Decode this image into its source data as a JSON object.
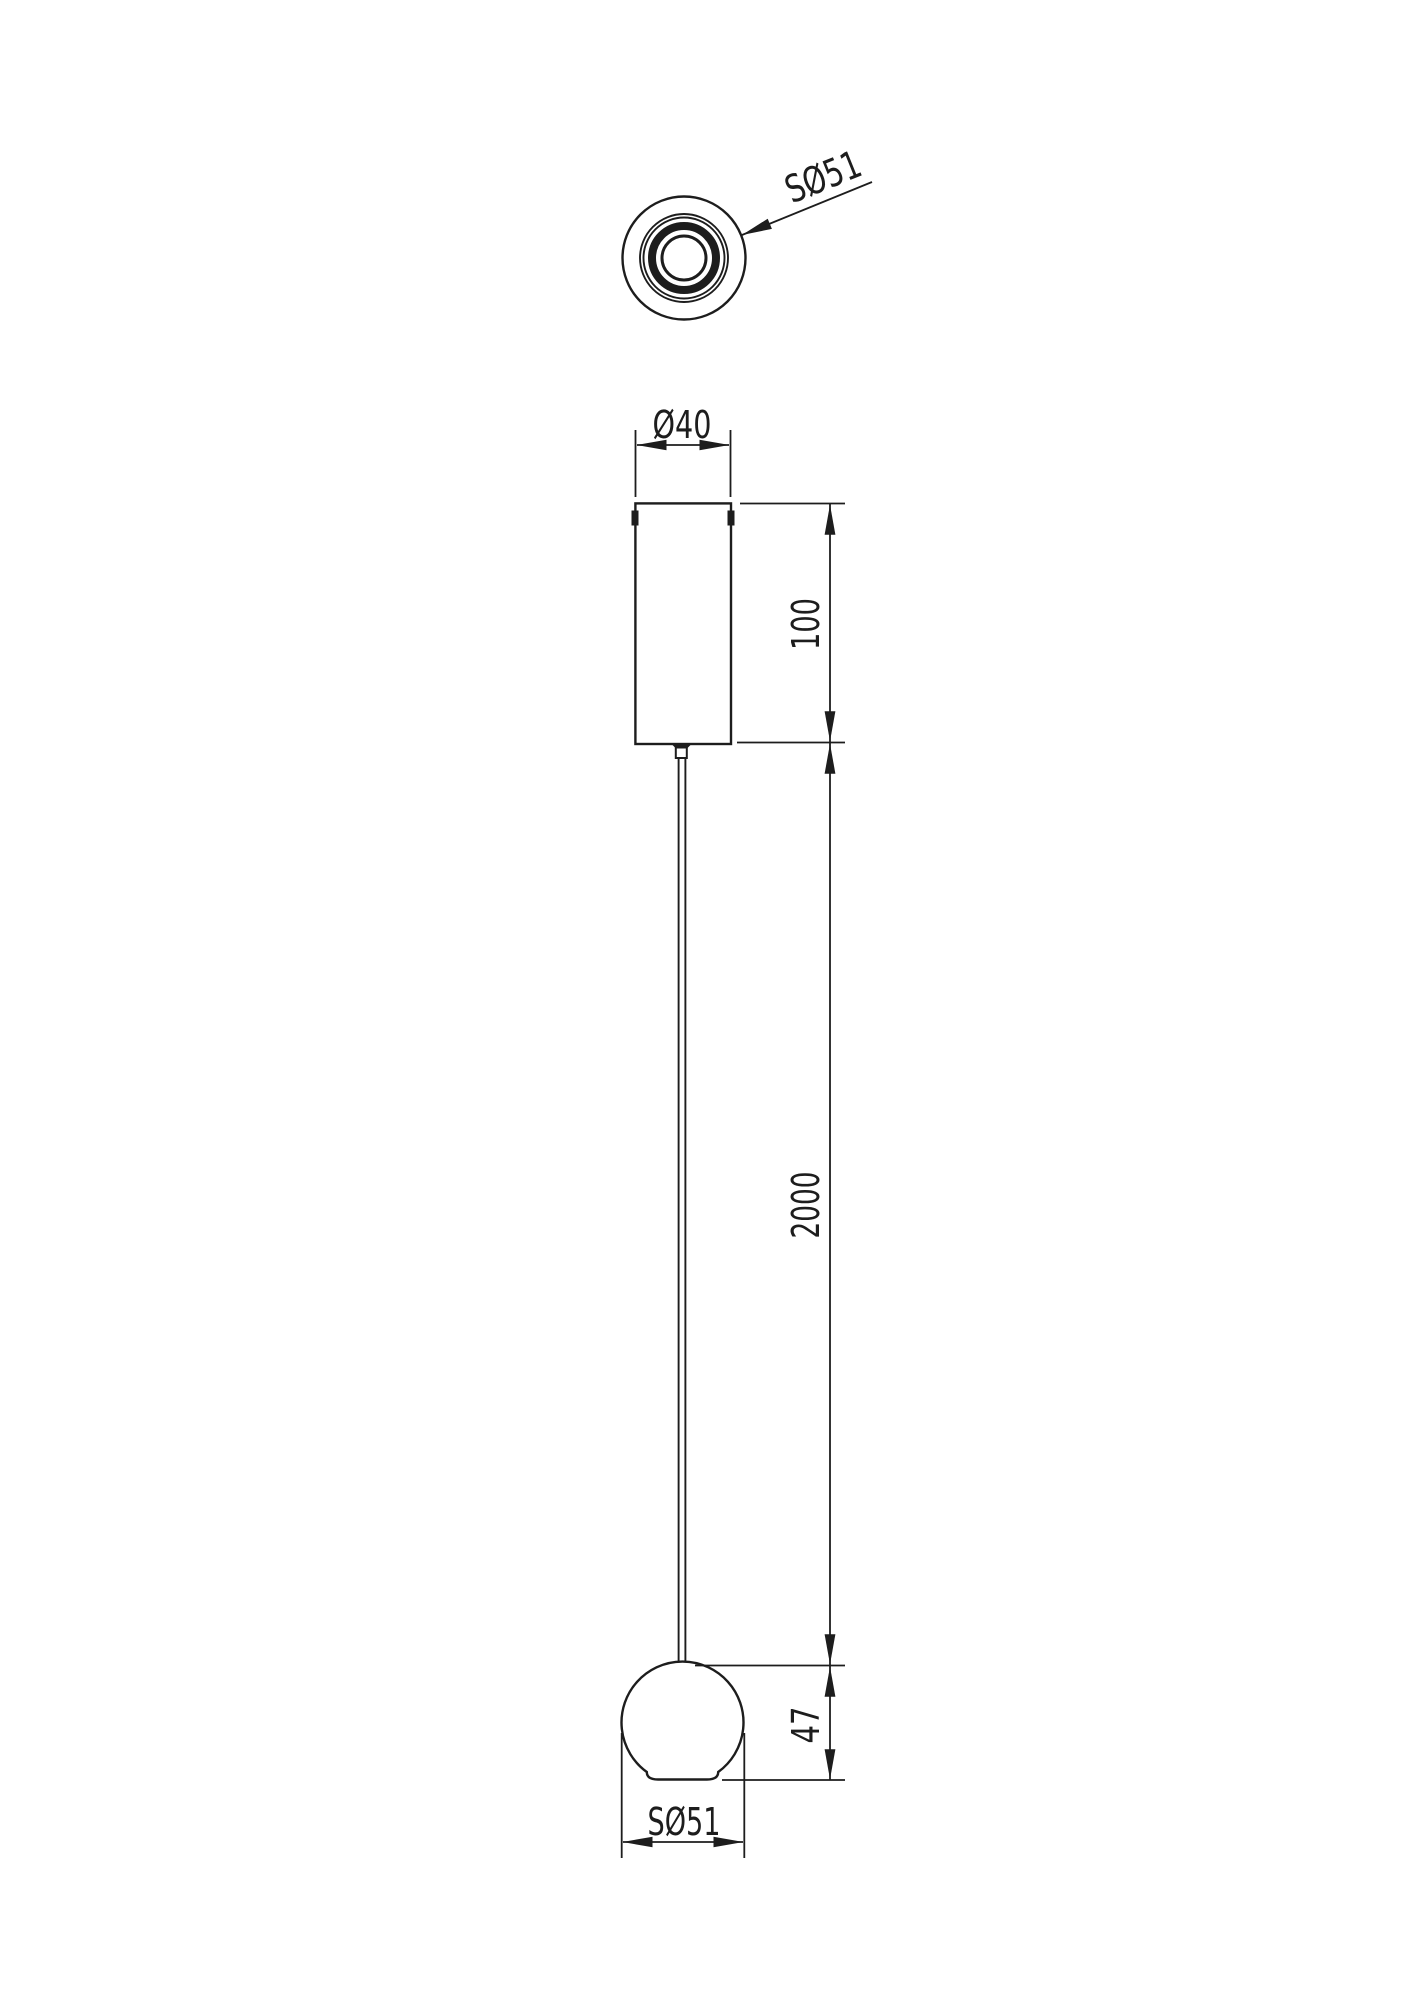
{
  "colors": {
    "background": "#ffffff",
    "line": "#1d1d1d"
  },
  "top_view": {
    "sphere_diameter_label": "SØ51"
  },
  "front_view": {
    "canopy_diameter_label": "Ø40",
    "canopy_height_label": "100",
    "cable_length_label": "2000",
    "sphere_height_label": "47",
    "sphere_diameter_label": "SØ51"
  }
}
